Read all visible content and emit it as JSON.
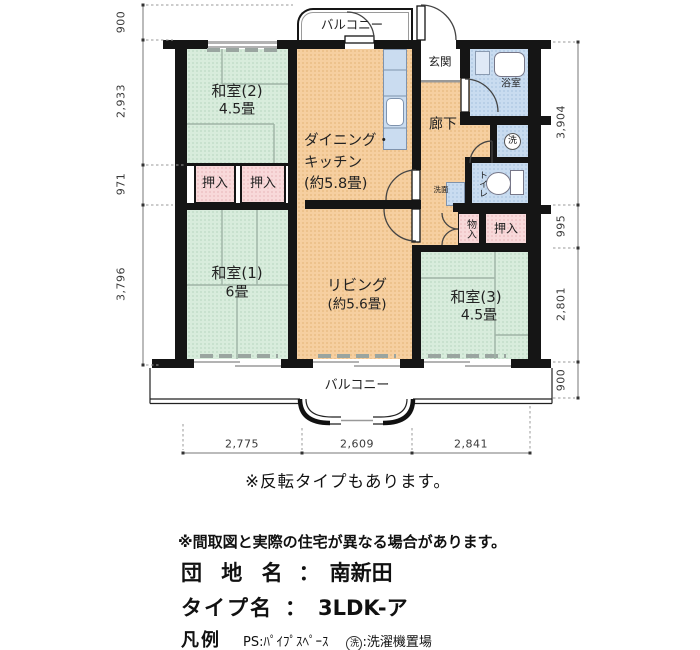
{
  "plan": {
    "balcony_top": "バルコニー",
    "balcony_bottom": "バルコニー",
    "rooms": {
      "washitsu2_name": "和室(2)",
      "washitsu2_size": "4.5畳",
      "washitsu1_name": "和室(1)",
      "washitsu1_size": "6畳",
      "washitsu3_name": "和室(3)",
      "washitsu3_size": "4.5畳",
      "dk_line1": "ダイニング・",
      "dk_line2": "キッチン",
      "dk_line3": "(約5.8畳)",
      "living_name": "リビング",
      "living_size": "(約5.6畳)",
      "genkan": "玄関",
      "rouka": "廊下",
      "yokushitsu": "浴室",
      "senmen": "洗面",
      "toilet": "トイレ",
      "washer_mark": "洗",
      "oshiire_a": "押入",
      "oshiire_b": "押入",
      "oshiire_c": "押入",
      "monoire": "物入"
    },
    "dims": {
      "left": [
        "900",
        "2,933",
        "971",
        "3,796"
      ],
      "right": [
        "3,904",
        "995",
        "2,801",
        "900"
      ],
      "bottom": [
        "2,775",
        "2,609",
        "2,841"
      ]
    }
  },
  "notes": {
    "flip": "※反転タイプもあります。",
    "disclaimer": "※間取図と実際の住宅が異なる場合があります。"
  },
  "info": {
    "estate_label": "団 地 名",
    "estate_sep": "：",
    "estate_value": "南新田",
    "type_label": "タイプ名",
    "type_sep": "：",
    "type_value": "3LDK-ア",
    "legend_title": "凡例",
    "legend_ps": "PS:ﾊﾟｲﾌﾟｽﾍﾟｰｽ",
    "legend_wash_mark": "洗",
    "legend_wash_text": ":洗濯機置場"
  },
  "colors": {
    "wall": "#151515",
    "tatami": "#d8ecdc",
    "flooring": "#f6cfa0",
    "closet": "#f8d9da",
    "wet_area": "#c9dcf0"
  }
}
